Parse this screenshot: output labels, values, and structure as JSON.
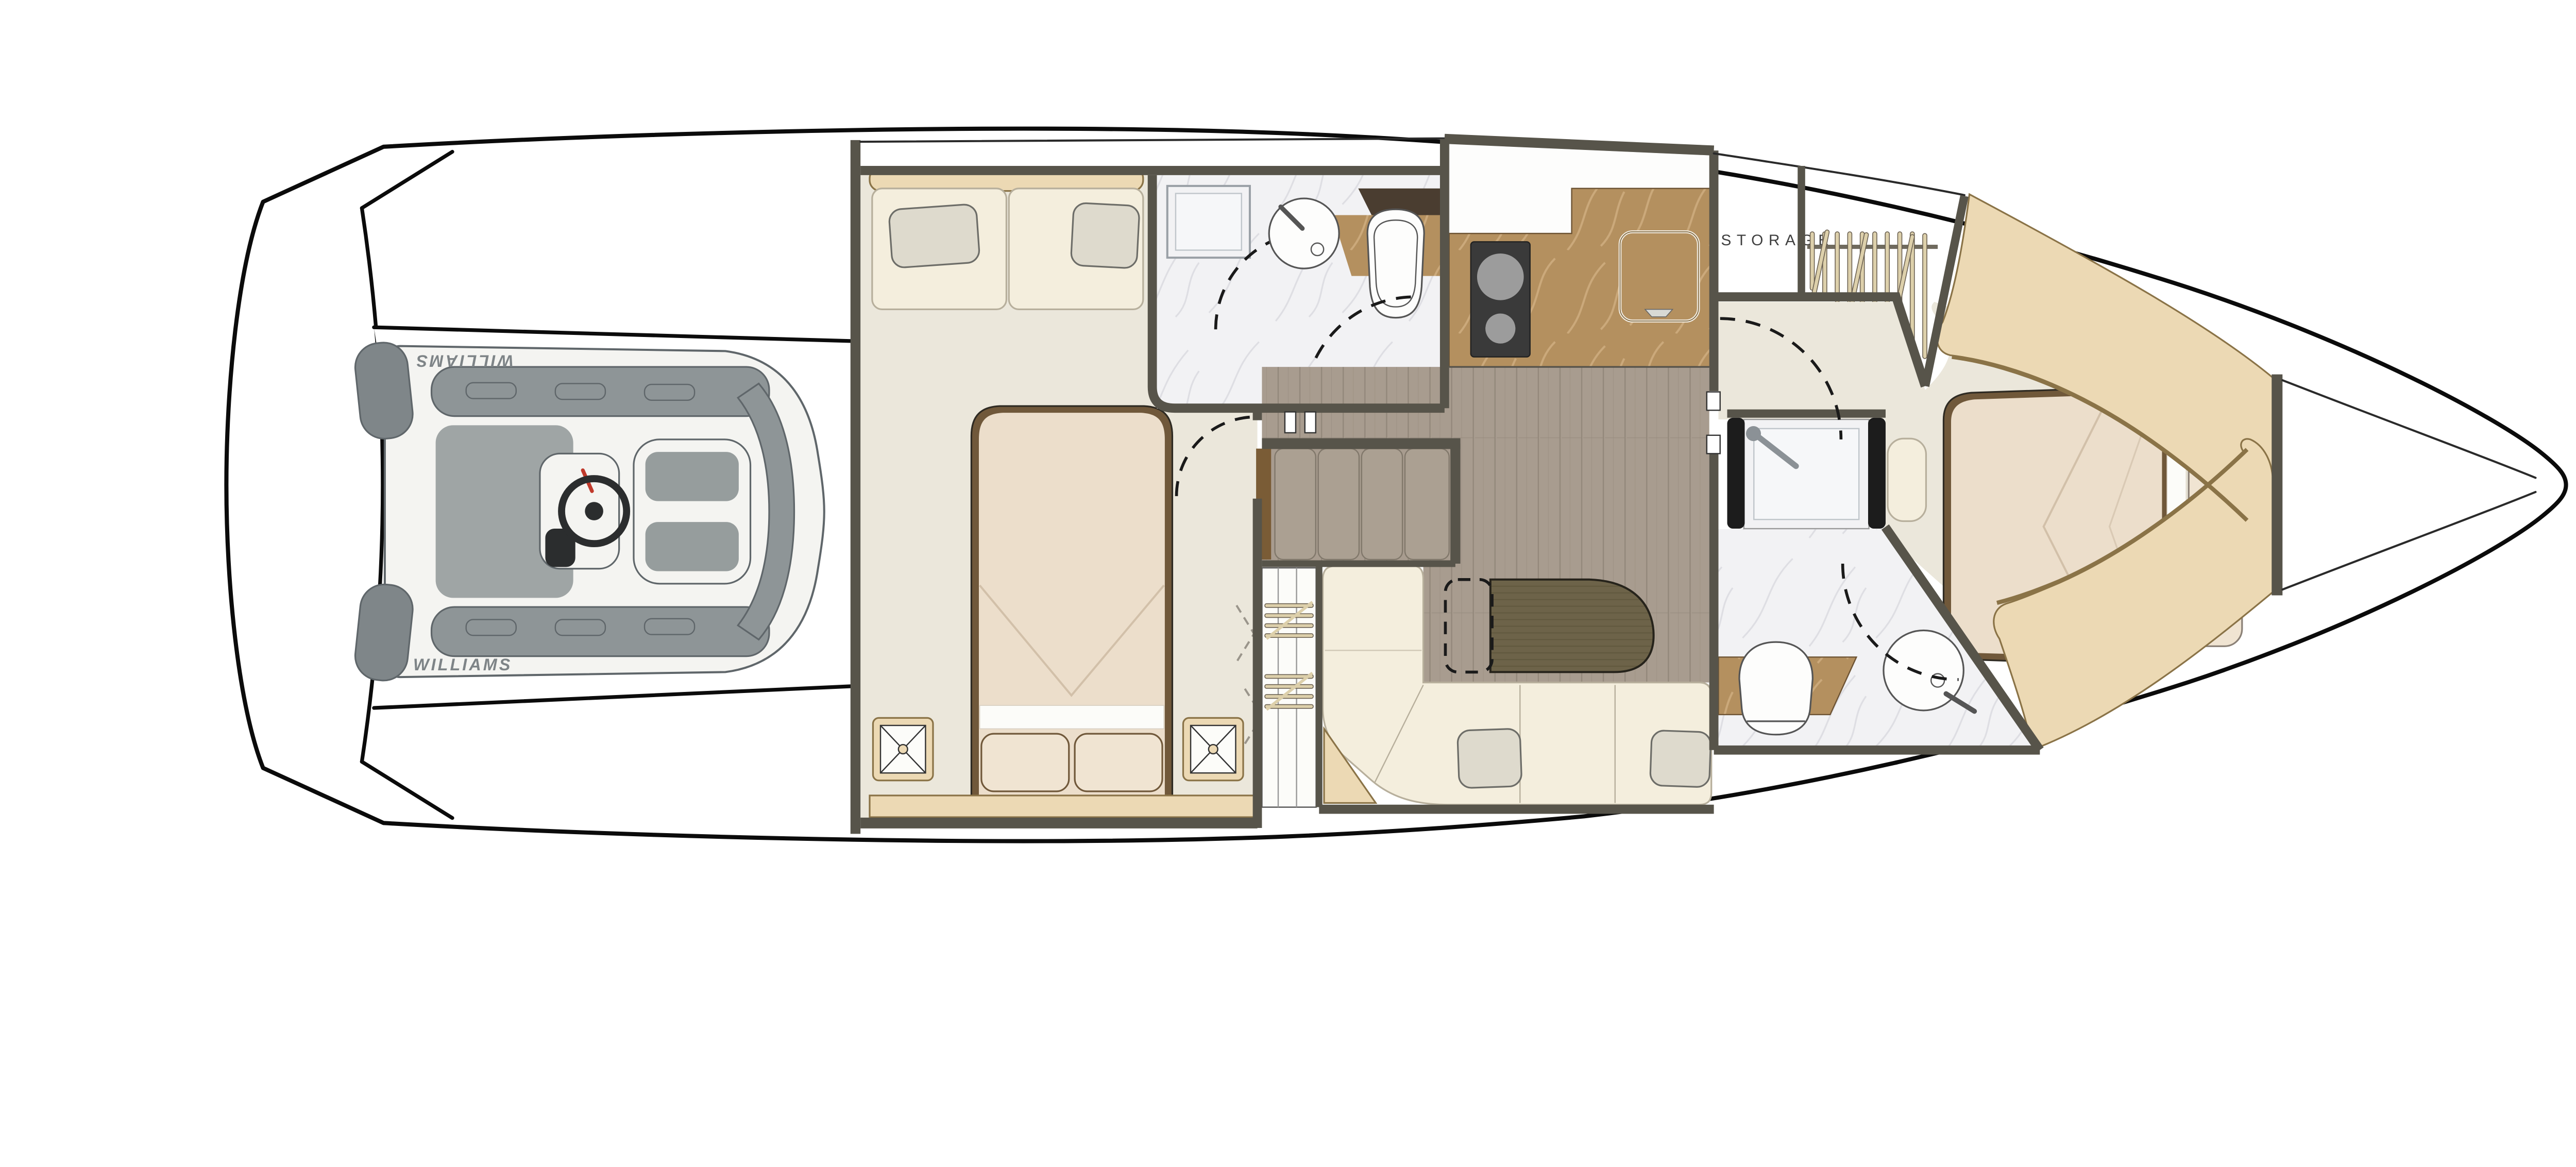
{
  "labels": {
    "storage": "STORAGE",
    "tender_brand_top": "WILLIAMS",
    "tender_brand_bottom": "WILLIAMS"
  },
  "colors": {
    "hull_line": "#0b0b0b",
    "inner_line": "#2a2a2a",
    "wall": "#57544a",
    "dashed_line": "#1a1a1a",
    "fold_door": "#9a958b",
    "carpet": "#ebe7db",
    "wood_floor": "#a89c8f",
    "wood_grain": "#93887b",
    "stair_tread": "#aba092",
    "stair_edge": "#81786b",
    "stair_panel": "#7a5c36",
    "table_wood": "#6d6349",
    "table_grain": "#575035",
    "counter_marble": "#b4905f",
    "counter_vein": "#d3b184",
    "cooktop": "#3a3a3a",
    "burner": "#9c9c9c",
    "marble_floor": "#f2f2f4",
    "marble_vein": "#d9dade",
    "tile_border": "#9aa0a6",
    "tan_trim": "#ecd9b4",
    "tan_border": "#8a7347",
    "bed_frame": "#70583a",
    "mattress": "#ecdecb",
    "mattress_fold": "#d2c0a9",
    "sheet_white": "#fcfcf9",
    "pillow_bed": "#f0e4d2",
    "sofa_cream": "#f4eedd",
    "sofa_outline": "#b7af9c",
    "pillow_gray": "#dedacd",
    "pillow_gray_outline": "#6d6d68",
    "fixture_white": "#fdfdfc",
    "fixture_outline": "#555555",
    "dark_shelf": "#4a3d30",
    "storage_text": "#3f3f3f",
    "hanger_rod": "#ddd0ab",
    "hanger_rod_edge": "#6b6152",
    "rail": "#6f6a5e",
    "tender_tube": "#f4f4f1",
    "tender_tube_edge": "#5f666a",
    "tender_pad": "#8e9597",
    "tender_cylinder": "#7f8689",
    "tender_floor": "#8f9698",
    "tender_seat_pad": "#969d9d",
    "tender_text": "#7e8487",
    "wheel_dark": "#2b2d2e",
    "lever_red": "#c0392b",
    "glass_dark": "#1c1c1c"
  }
}
